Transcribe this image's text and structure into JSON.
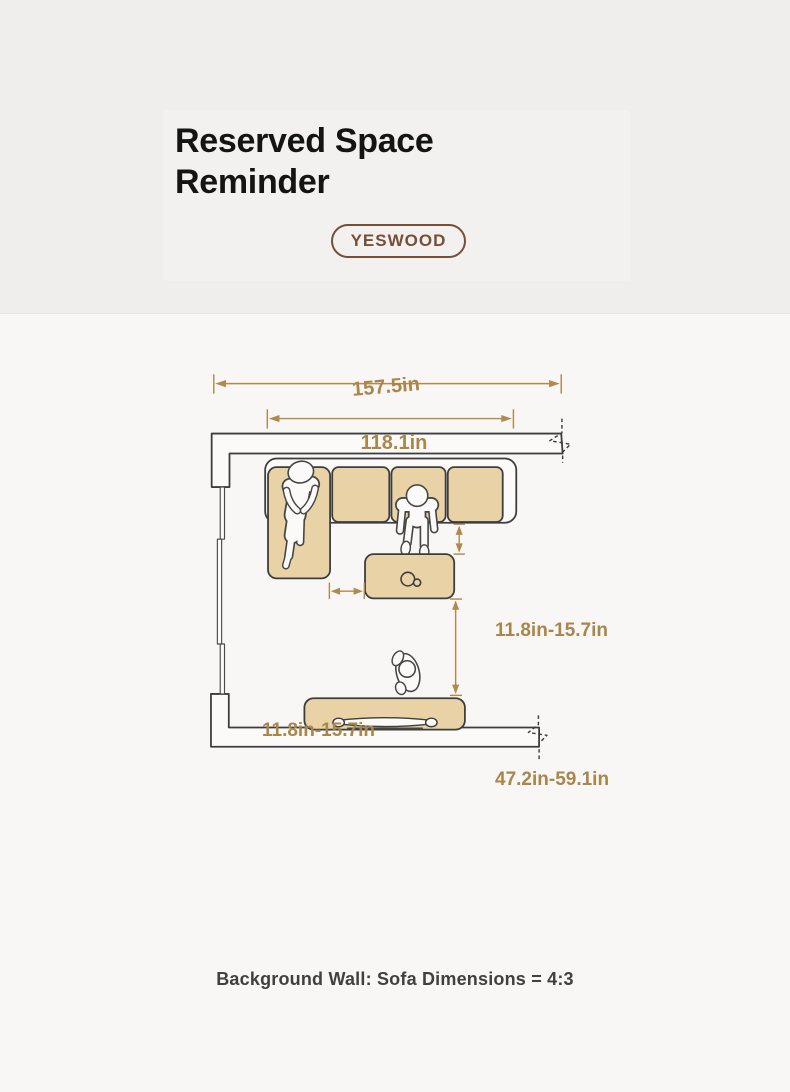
{
  "header": {
    "title_line1": "Reserved Space",
    "title_line2": "Reminder",
    "brand_badge": "YESWOOD"
  },
  "diagram": {
    "dimensions": {
      "room_width": "157.5in",
      "sofa_width": "118.1in",
      "sofa_to_table": "11.8in-15.7in",
      "chaise_to_table": "11.8in-15.7in",
      "table_to_tv": "47.2in-59.1in"
    },
    "caption": "Background Wall: Sofa Dimensions = 4:3",
    "colors": {
      "furniture_fill": "#e9d2a6",
      "outline": "#3d3d3d",
      "dimension_gold": "#b0894e",
      "brand_brown": "#774f36"
    }
  }
}
